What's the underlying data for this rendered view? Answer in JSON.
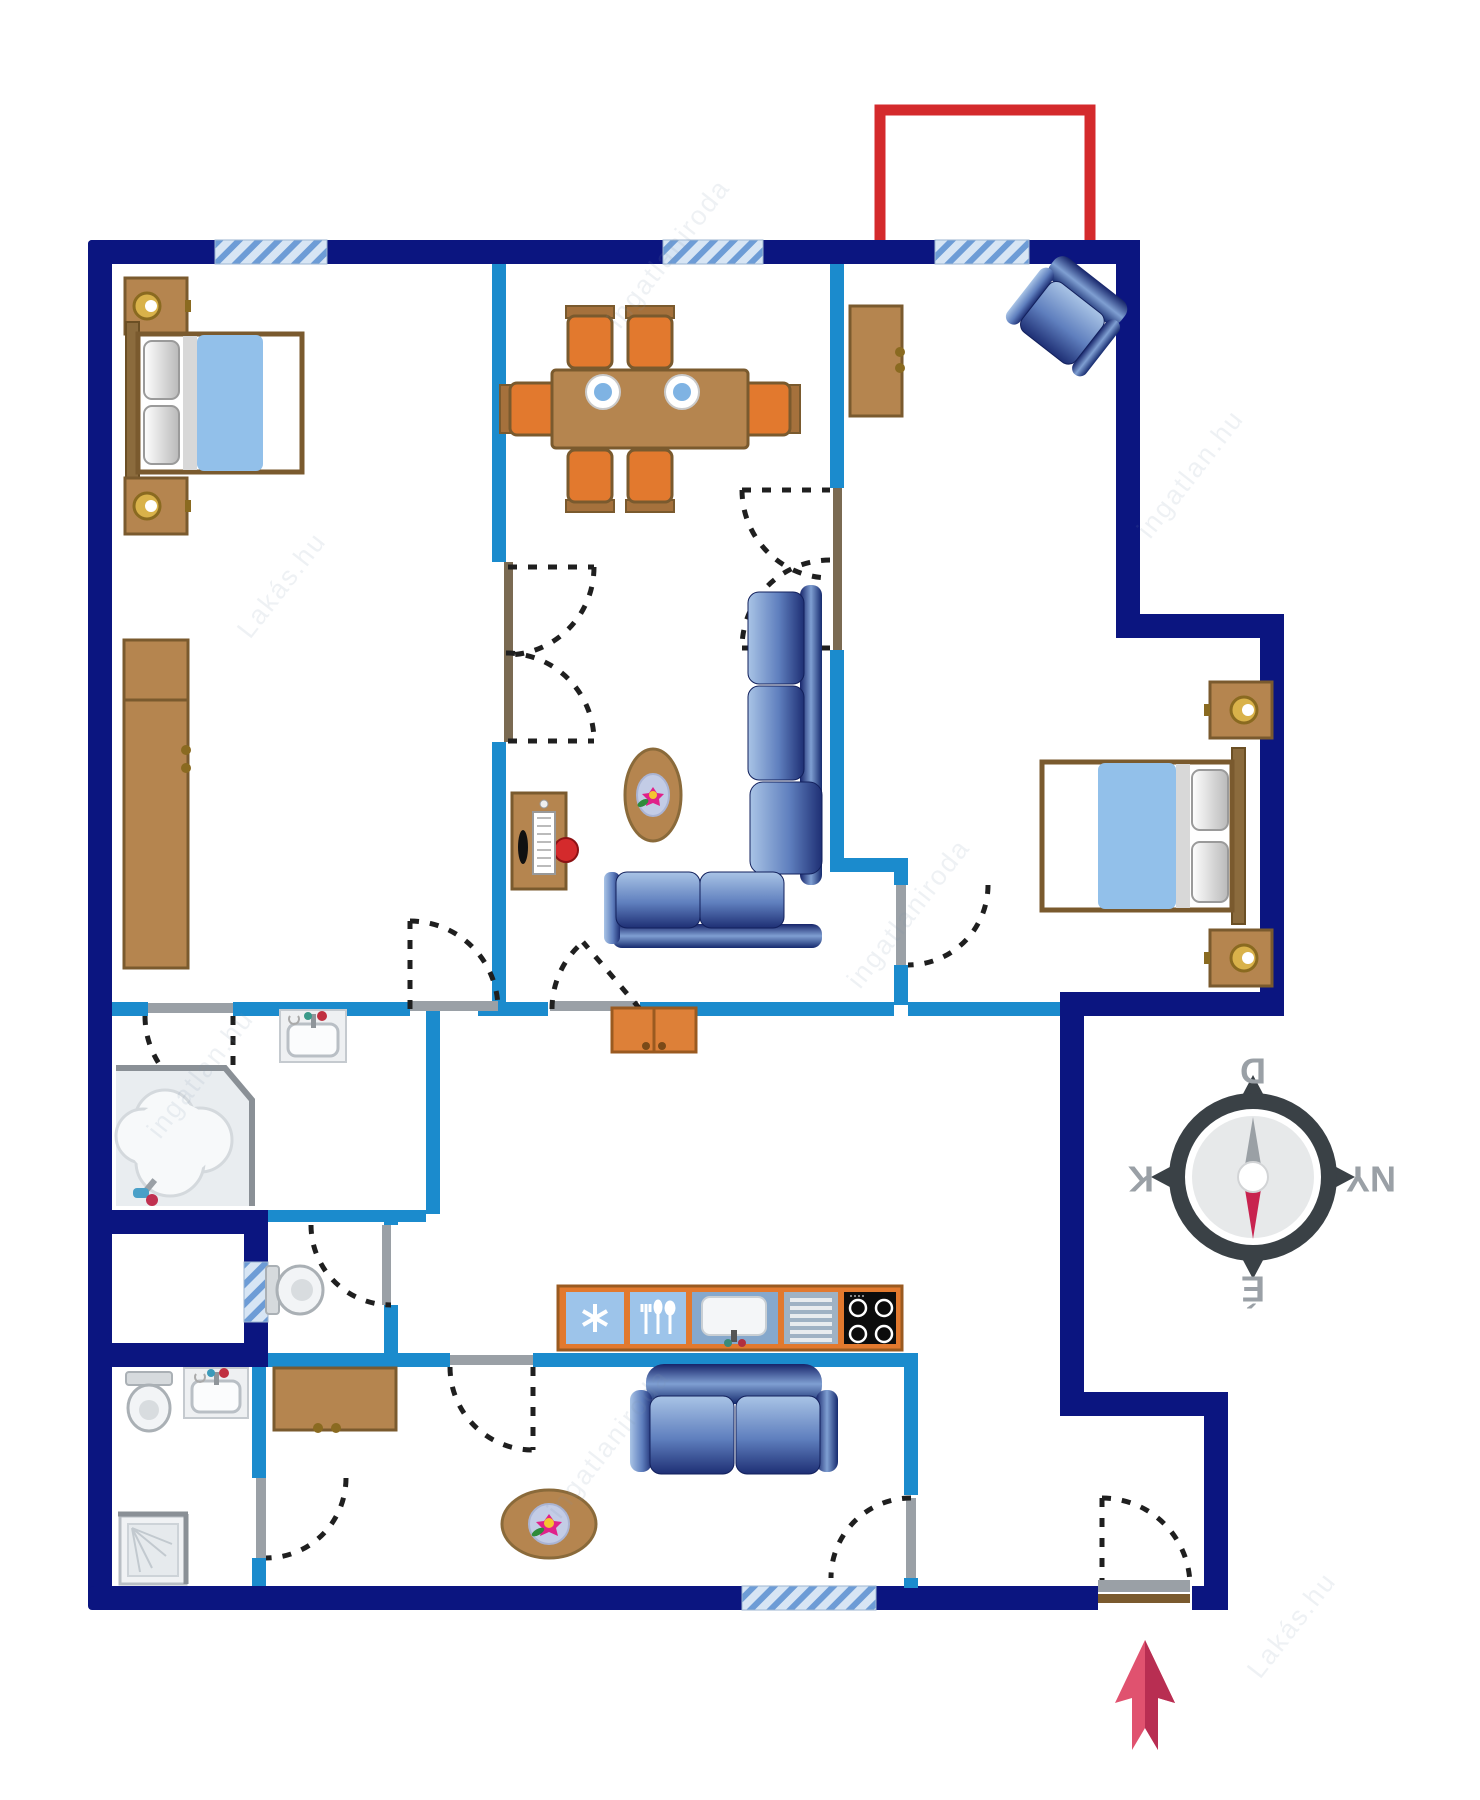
{
  "page": {
    "title": "Apartment floor plan",
    "type": "floor-plan-diagram"
  },
  "compass": {
    "top": "D",
    "right": "NY",
    "bottom": "É",
    "left": "K"
  },
  "watermark": {
    "items": [
      "Lakás.hu",
      "ingatlaniroda",
      "ingatlan.hu"
    ]
  },
  "colors": {
    "outer_wall_navy": "#0b1580",
    "inner_wall_blue": "#1b8bcd",
    "window_stripe_blue": "#6d9cd6",
    "window_bg": "#d7e5f4",
    "balcony_red": "#d42a2c",
    "entrance_arrow_red": "#e0526f",
    "entrance_arrow_red_dark": "#b82e52",
    "furniture_brown": "#b5854f",
    "chair_orange": "#e2792e",
    "bed_blanket_blue": "#92c0ea",
    "sofa_blue_light": "#a9c4e6",
    "sofa_blue_dark": "#1e2f74",
    "compass_ring": "#3a4146",
    "compass_needle_red": "#c8234f",
    "compass_needle_gray": "#9aa0a5"
  },
  "rooms": [
    {
      "id": "bedroom-left",
      "furniture": [
        "double-bed",
        "nightstand-lamp",
        "nightstand-lamp",
        "wardrobe"
      ]
    },
    {
      "id": "dining-living-center",
      "furniture": [
        "dining-table-6-chairs",
        "computer-desk",
        "oval-coffee-table-flower",
        "l-shaped-sofa"
      ]
    },
    {
      "id": "bedroom-right",
      "furniture": [
        "armchair",
        "cabinet",
        "double-bed",
        "nightstand-lamp",
        "nightstand-lamp"
      ]
    },
    {
      "id": "bathroom-main",
      "furniture": [
        "washbasin",
        "corner-bathtub"
      ]
    },
    {
      "id": "wc",
      "furniture": [
        "toilet"
      ]
    },
    {
      "id": "kitchen-hall",
      "furniture": [
        "sideboard-cabinet",
        "kitchen-counter-fridge-cutlery-sink-drainer-stove"
      ]
    },
    {
      "id": "bathroom-second",
      "furniture": [
        "toilet",
        "washbasin",
        "shower-cabin"
      ]
    },
    {
      "id": "hall-bottom",
      "furniture": [
        "desk-cabinet",
        "two-seat-sofa",
        "oval-table-flower"
      ]
    },
    {
      "id": "balcony",
      "furniture": []
    },
    {
      "id": "entry-vestibule",
      "furniture": [
        "entrance-door"
      ]
    }
  ]
}
